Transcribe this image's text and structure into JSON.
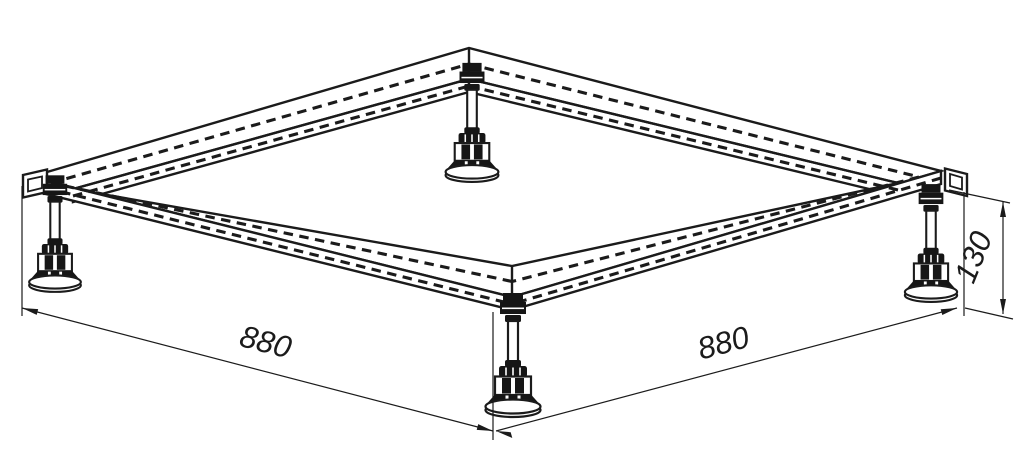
{
  "drawing": {
    "kind": "isometric technical drawing",
    "subject": "square support frame with four adjustable leveling feet",
    "colors": {
      "line": "#1b1b1b",
      "background": "#ffffff"
    }
  },
  "dimensions": {
    "left_width": "880",
    "right_width": "880",
    "height": "130"
  }
}
